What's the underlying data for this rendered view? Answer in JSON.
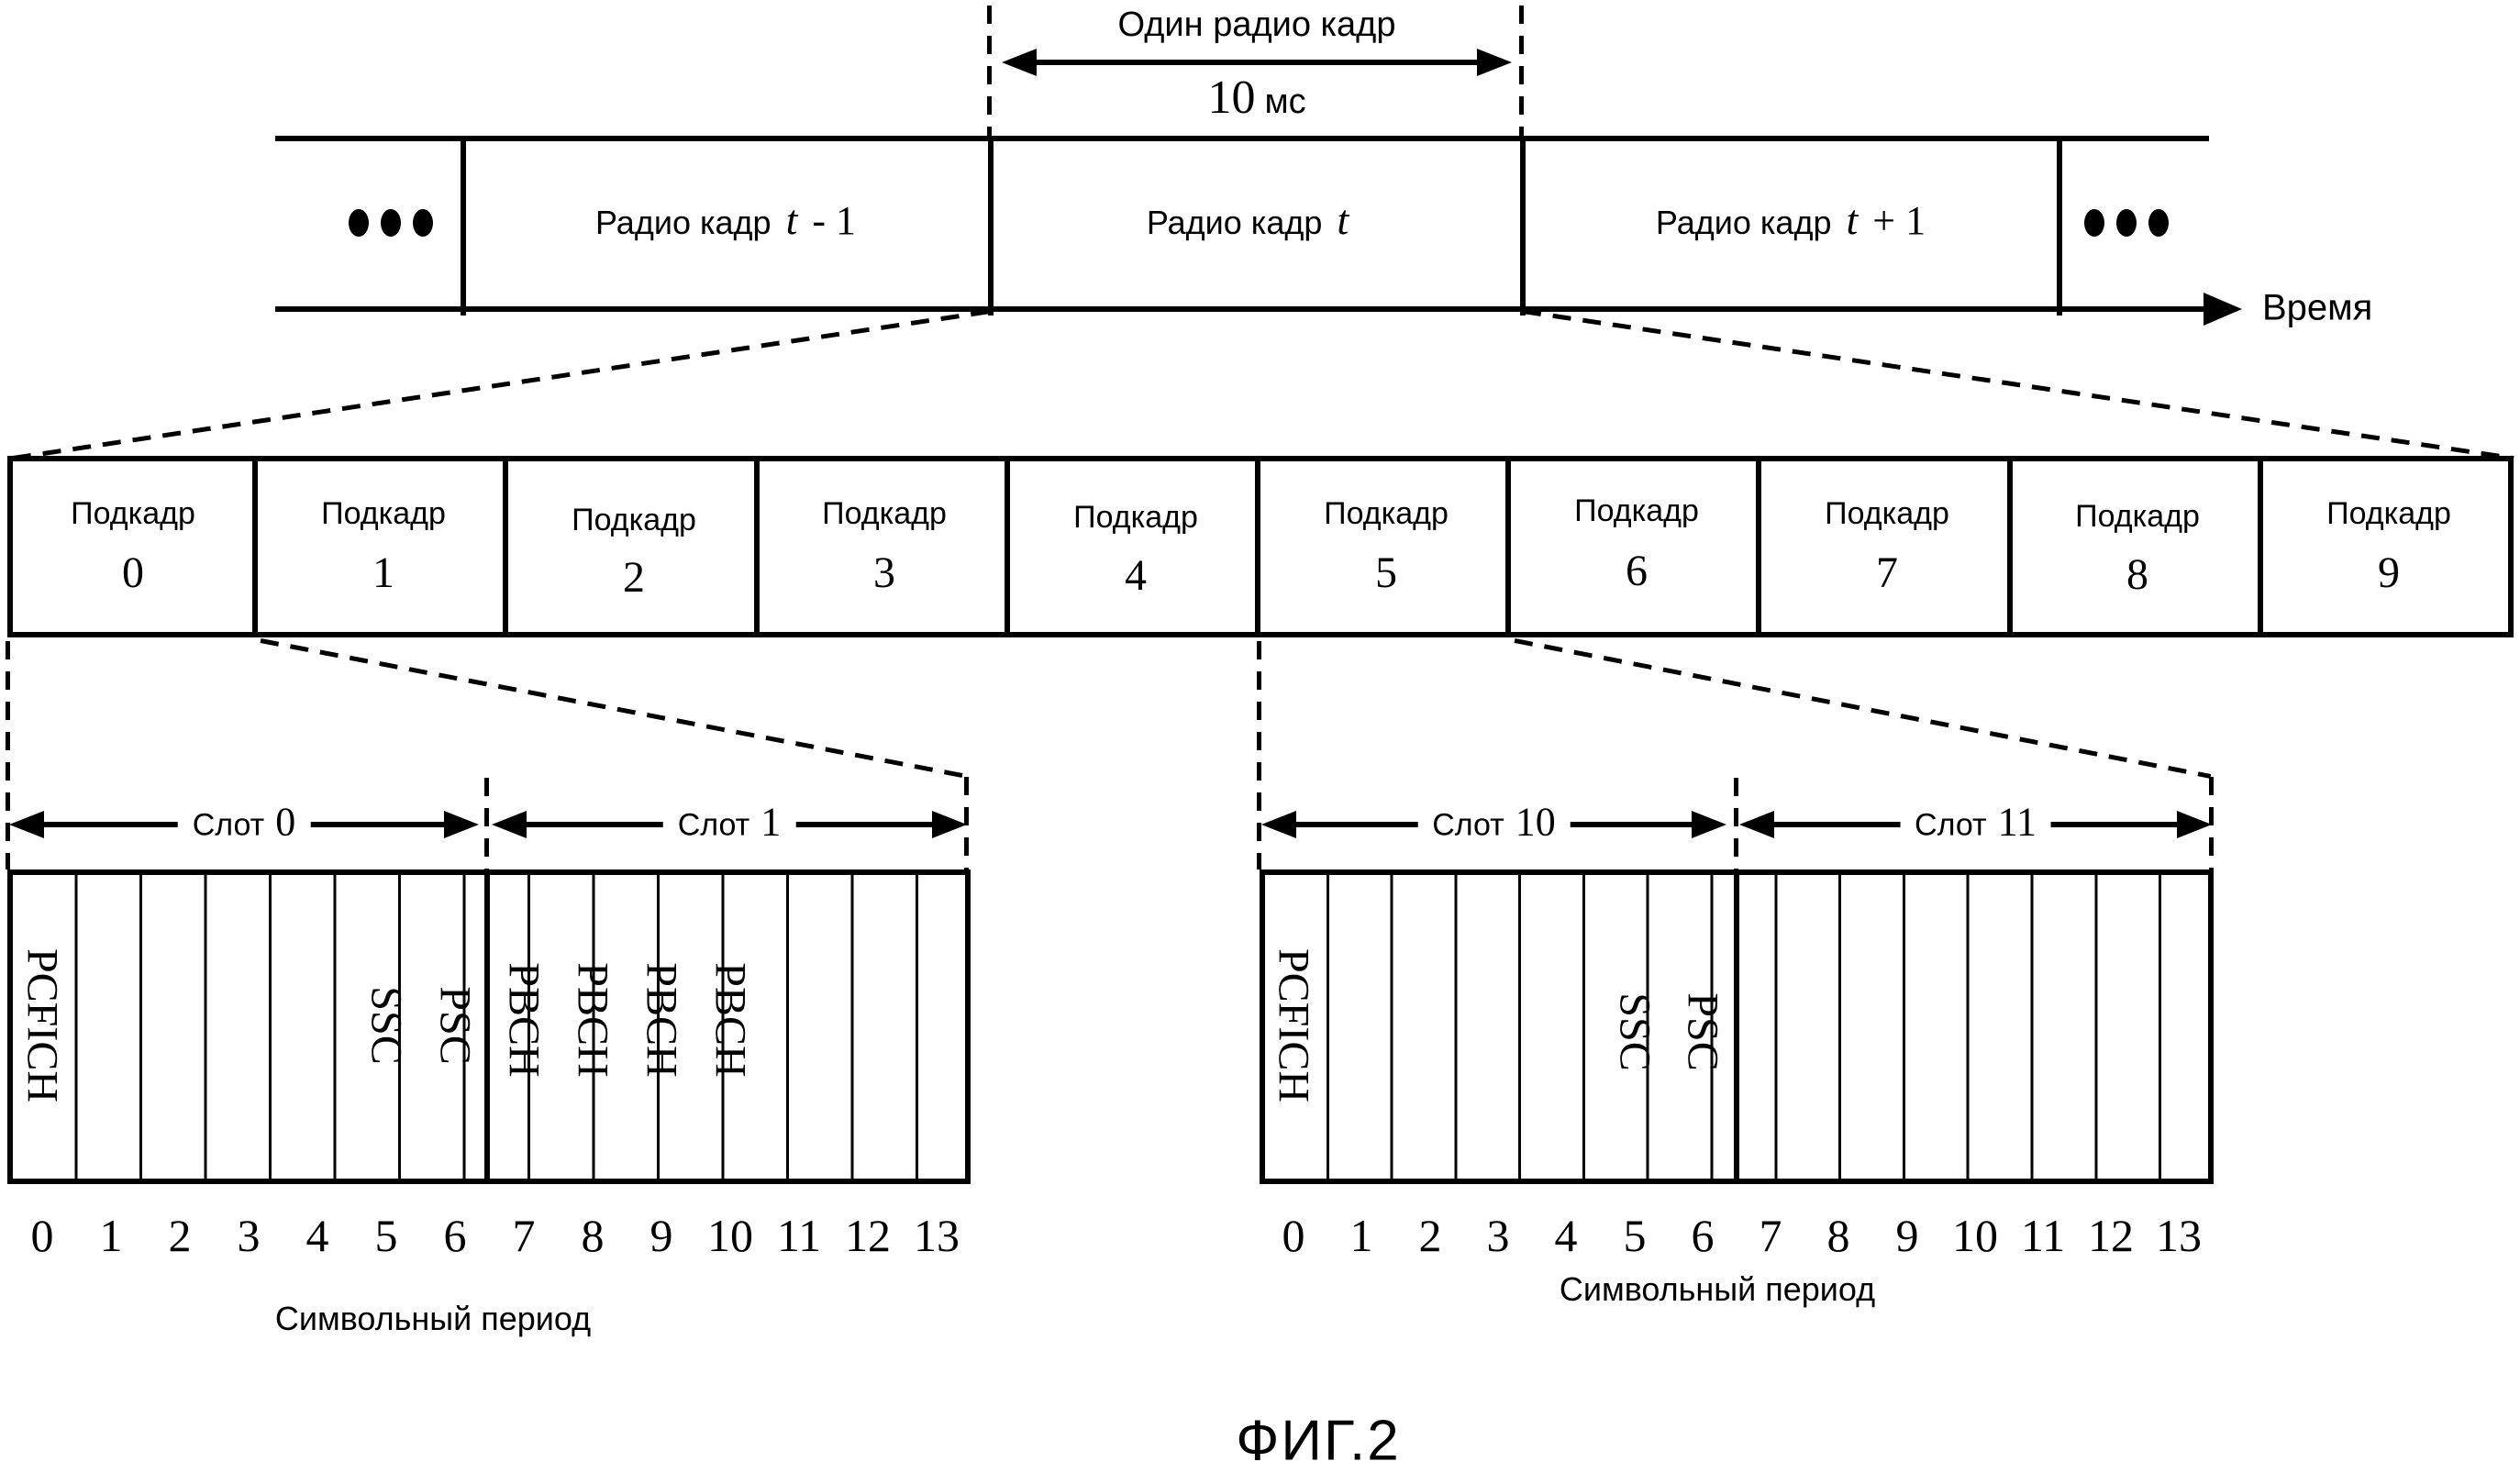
{
  "figure_caption": "ФИГ.2",
  "timeline": {
    "one_frame_label": "Один радио кадр",
    "duration_value": "10",
    "duration_unit": "мс",
    "axis_label": "Время",
    "frames": [
      {
        "word": "Радио кадр",
        "var": "t",
        "suffix": "- 1"
      },
      {
        "word": "Радио кадр",
        "var": "t",
        "suffix": ""
      },
      {
        "word": "Радио кадр",
        "var": "t",
        "suffix": "+ 1"
      }
    ]
  },
  "subframes": {
    "word": "Подкадр",
    "numbers": [
      "0",
      "1",
      "2",
      "3",
      "4",
      "5",
      "6",
      "7",
      "8",
      "9"
    ]
  },
  "slots": {
    "word": "Слот",
    "left": [
      "0",
      "1"
    ],
    "right": [
      "10",
      "11"
    ]
  },
  "grids": {
    "left": {
      "channels": {
        "c0": "PCFICH",
        "c5": "SSC",
        "c6": "PSC",
        "c7": "PBCH",
        "c8": "PBCH",
        "c9": "PBCH",
        "c10": "PBCH"
      },
      "symbols": [
        "0",
        "1",
        "2",
        "3",
        "4",
        "5",
        "6",
        "7",
        "8",
        "9",
        "10",
        "11",
        "12",
        "13"
      ],
      "caption": "Символьный период"
    },
    "right": {
      "channels": {
        "c0": "PCFICH",
        "c5": "SSC",
        "c6": "PSC"
      },
      "symbols": [
        "0",
        "1",
        "2",
        "3",
        "4",
        "5",
        "6",
        "7",
        "8",
        "9",
        "10",
        "11",
        "12",
        "13"
      ],
      "caption": "Символьный период"
    }
  }
}
